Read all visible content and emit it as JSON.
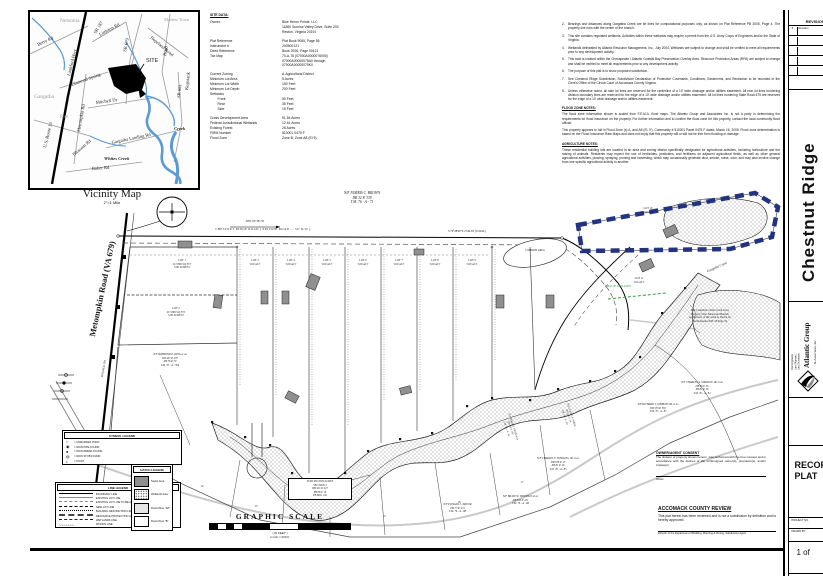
{
  "colors": {
    "navy_dash": "#23337f",
    "septic_fill": "#8f8f8f",
    "flood_gray": "#c9c9c9",
    "green_line": "#2e9e3a",
    "creek_blue": "#5b9bd5"
  },
  "vicinity": {
    "caption": "Vicinity Map",
    "scale": "2\"=1 Mile",
    "labels": {
      "nelsonia": "Nelsonia",
      "modest_town": "Modest\nTown",
      "gargatha": "Gargatha",
      "rue": "Rue",
      "berry": "Berry Rd",
      "lankford": "Lankford Hwy",
      "us13": "U.S. Route 13",
      "diamond": "Diamond\nSpring",
      "metompkin": "Metompkin Rd",
      "mitchell": "Mitchell Dr",
      "sr187": "SR 187",
      "sr679": "SR 679",
      "sr681": "SR 681",
      "littleton": "Littleton Rd",
      "hopeland": "Hopeland Road",
      "kegotank": "Kegotank",
      "road": "Road",
      "gargatha_landing": "Gargatha Landing Rd",
      "baker": "Baker Rd",
      "blossom": "Blossom Rd",
      "whites_creek": "Whites Creek",
      "creek": "Creek",
      "site": "SITE"
    }
  },
  "site_data": {
    "heading": "SITE DATA:",
    "rows": [
      {
        "label": "Owner:",
        "value": "Blue Heron Pointe, LLC\n11860 Sunrise Valley Drive, Suite 200\nReston, Virginia 20191",
        "cls": ""
      },
      {
        "label": "Plat Reference",
        "value": "Plat Book 9065, Page 56",
        "cls": "gap"
      },
      {
        "label": "Instrument #",
        "value": "200500121",
        "cls": ""
      },
      {
        "label": "Deed Reference",
        "value": "Book 2926, Page 00121",
        "cls": ""
      },
      {
        "label": "Tax Map",
        "value": "70-A-76 (07000A0000076000)\n07000A00000075A0 through\n07000A00000075K0",
        "cls": ""
      },
      {
        "label": "Current Zoning",
        "value": "A-Agricultural District",
        "cls": "gap"
      },
      {
        "label": "Minimum Lot Area",
        "value": "5 Acres",
        "cls": ""
      },
      {
        "label": "Minimum Lot Width",
        "value": "150 Feet",
        "cls": ""
      },
      {
        "label": "Minimum Lot Depth",
        "value": "200 Feet",
        "cls": ""
      },
      {
        "label": "Setbacks",
        "value": "",
        "cls": ""
      },
      {
        "label": "        Front",
        "value": "50 Feet",
        "cls": ""
      },
      {
        "label": "        Rear",
        "value": "35 Feet",
        "cls": ""
      },
      {
        "label": "        Side",
        "value": "15 Feet",
        "cls": ""
      },
      {
        "label": "Gross Development Area",
        "value": "91.54 Acres",
        "cls": "gap"
      },
      {
        "label": "Federal Jurisdictional Wetlands",
        "value": "12.61 Acres",
        "cls": ""
      },
      {
        "label": "Existing Forest",
        "value": "26 Acres",
        "cls": ""
      },
      {
        "label": "FIRM Number",
        "value": "510001 0475 F",
        "cls": ""
      },
      {
        "label": "Flood Zone",
        "value": "Zone B, Zone A8 (El 9)",
        "cls": ""
      }
    ]
  },
  "notes": {
    "items": [
      {
        "n": "2.",
        "text": "Bearings and distances along Gargatha Creek are tie lines for computational purposes only, as shown on Plat Reference PB 3005, Page 4. The property line runs with the center of the branch."
      },
      {
        "n": "3.",
        "text": "This site contains regulated wetlands. Activities within these wetlands may require a permit from the U.S. Army Corps of Engineers and/or the State of Virginia."
      },
      {
        "n": "4.",
        "text": "Wetlands delineated by Atlantic Resource Management, Inc., July 2004. Wetlands are subject to change and shall be verified to meet all requirements prior to any development activity."
      },
      {
        "n": "5.",
        "text": "This tract is located within the Chesapeake / Atlantic Coastal Bay Preservation Overlay Area. Resource Protection Areas (RPA) are subject to change and shall be verified to meet all requirements prior to any development activity."
      },
      {
        "n": "6.",
        "text": "The purpose of this plat is to show proposed subdivision."
      },
      {
        "n": "7.",
        "text": "See Chestnut Ridge Subdivision, Subdivision Declaration of Protective Covenants, Conditions, Easements, and Restriction to be recorded in the Clerk's Office of the Circuit Court of Accomack County Virginia."
      },
      {
        "n": "8.",
        "text": "Unless otherwise noted, all side lot lines are reserved for the centerline of a 10' wide drainage and/or utilities easement. All rear lot lines bordering division boundary lines are reserved for the edge of a 10' wide drainage and/or utilities easement. All lot lines bordering State Road 679 are reserved for the edge of a 10' wide drainage and/or utilities easement."
      }
    ],
    "flood_heading": "FLOOD ZONE NOTES:",
    "flood_paras": [
      "The flood zone information shown is scaled from F.E.M.A. flood maps. The Atlantic Group and Associates Inc. is not a party in determining the requirements for flood insurance on the property. For further information and to confirm the flood zone for this property, contact the local community flood official.",
      "This property appears to fall in Flood Zone (s) A, and A8 (El. 9'). Community # 510001 Panel 0475 F dated, March 16, 2009. Flood zone determination is based on the Flood Insurance Rate Maps and does not imply that this property will or will not be free from flooding or damage."
    ],
    "agri_heading": "AGRICULTURE NOTES:",
    "agri_paras": [
      "These residential building lots are located in an area and zoning district specifically designated for agricultural activities, including horticulture and the raising of animals. Residents may expect the use of herbicides, pesticides, and fertilizers on adjacent agricultural fields, as well as other general agricultural activities, plowing, spraying, pruning and harvesting, which may occasionally generate dust, smoke, noise, odor, and may also involve change from one specific agricultural activity to another."
    ]
  },
  "plan": {
    "roads": {
      "metompkin": "Metompkin Road (VA 679)",
      "mitchell": "MITCHELL DR",
      "chestnut": "CHESTNUT RIDGE ROAD    ( PRIVATE ROAD — 50' R/W )",
      "bearing": "S 79°28'00\"E   2746.38' (TOTAL)",
      "tie": "DIST OF 387.50'"
    },
    "lots": {
      "lot1": "LOT 1\n217,800 SQ FT±\n5.00 ACRES±",
      "lot2": "LOT 2\n217,800 SQ FT±\n5.00 ACRES±",
      "lot3": "LOT 3\n5.00 AC±",
      "lot4": "LOT 4\n5.00 AC±",
      "lot5": "LOT 5\n5.00 AC±",
      "lot6": "LOT 6\n5.00 AC±",
      "lot7": "LOT 7\n5.00 AC±",
      "lot8": "LOT 8\n5.00 AC±",
      "lot9": "LOT 9\n5.00 AC±",
      "lot10": "LOT 10\n4.50 AC±",
      "lot11": "LOT 11\n5.04 AC±",
      "p12": "12",
      "p13": "13",
      "p14": "14",
      "p15": "15",
      "p16": "16",
      "p17": "17"
    },
    "neighbors": {
      "brown": "N/F NORRIS C. BROWN\nDB 32 P. 339\nT.M. 76 - A - 71",
      "king": "N/F RAYMOND E. KING et ux\nDB 467 P. 297\nPB 76 P. 79\nT.M. 76 - A - 76A",
      "taylor": "N/F DONALD J. TAYLOR\nDB 77 P. 474\nT.M. 76 - A - 88",
      "wessells": "N/F BILLIE W. WESSELLS et ux\nDB 553 P. 231\nT.M. 76 - A - 86",
      "sterling": "N/F CHARLES F. STERLING JR. et ux\nDB 678 P. 47\nPB 81 P. 16\nT.M. 76 - A - 85",
      "gibbons": "N/F RICHARD T. GIBBONS JR. et ux\nDB 553 P. 565\nT.M. 76 - A - 87",
      "strange": "N/F CHARLES A. STRANGE JR. et ux\nDB 96 P. 56\nPB 81 P. 56\nT.M. 76 - A - 84",
      "annis": "N/F JAMES R. ANNIS et ux\nDB 409 P. 180\nT.M. 76 - A - 82",
      "parks": "N/F GLADYS S. PARKS\nDB 380 P. 44\nT.M. 76 - A - 83"
    },
    "annotations": {
      "creek_note": "The Centerline of the Creek is the\nProperty Line. Metes and Bounds\nare hollows of the creek as shown on\nPlat Reference P.B. 96 Page 56.",
      "turlington": "TURLINGTON ACRES\nSECTION 2\nDB 451 P. 227\nPB 88 P. 16\nPB 88 P. 110",
      "gargatha_creek": "Gargatha Creek",
      "common_area": "COMMON AREA",
      "green_mark": "EDGE OF WETLANDS"
    }
  },
  "symbol_legend": {
    "title": "SYMBOL LEGEND",
    "items": [
      {
        "glyph": "○",
        "label": "=  UNMARKED POINT"
      },
      {
        "glyph": "◉",
        "label": "=  IRON PIPE FOUND"
      },
      {
        "glyph": "●",
        "label": "=  IRON REBAR FOUND"
      },
      {
        "glyph": "◍",
        "label": "=  IRON STOB FOUND"
      },
      {
        "glyph": "•",
        "label": "=  POINT"
      }
    ]
  },
  "line_legend": {
    "title": "LINE LEGEND",
    "items": [
      {
        "style": "ls-bound",
        "glyph": "",
        "label": "BOUNDARY LINE"
      },
      {
        "style": "ls-exist",
        "glyph": "",
        "label": "EXISTING LOT LINE"
      },
      {
        "style": "ls-aband",
        "glyph": "",
        "label": "EXISTING LOT LINE TO BE ABANDONED"
      },
      {
        "style": "ls-new",
        "glyph": "",
        "label": "NEW LOT LINE"
      },
      {
        "style": "ls-brl",
        "glyph": "",
        "label": "BUILDING RESTRICTION LINE"
      },
      {
        "style": "ls-rpa",
        "glyph": "",
        "label": "RESOURCE PROTECTION AREA BUFFER"
      },
      {
        "style": "ls-wet",
        "glyph": "",
        "label": "WETLANDS LINE"
      },
      {
        "style": "ls-woods",
        "glyph": "∿∿∿∿∿∿∿",
        "label": "WOODS LINE"
      }
    ]
  },
  "hatch_legend": {
    "title": "HATCH LEGEND",
    "items": [
      {
        "style": "hs-septic",
        "label": "Septic Area"
      },
      {
        "style": "hs-wet",
        "label": "Wetlands Area"
      },
      {
        "style": "hs-fa8",
        "label": "Flood Zone \"A8\""
      },
      {
        "style": "hs-fb",
        "label": "Flood Zone \"B\""
      }
    ]
  },
  "scale": {
    "title": "GRAPHIC SCALE",
    "caption": "( IN FEET )\n1 inch = 200 ft."
  },
  "consent": {
    "title": "OWNER/AGENT CONSENT",
    "body": "The division of property shown hereon, was performed with the free consent and in accordance with the desires of the undersigned owner(s), proprietor(s), and/or trustee(s).",
    "sig": "Owner"
  },
  "review": {
    "title": "ACCOMACK COUNTY REVIEW",
    "body": "This plat herein has been reviewed and is not a subdivision by definition and is hereby approved.",
    "sig": "Director of the Department of Building, Planning & Zoning, Subdivision Agent"
  },
  "title_block": {
    "revisions": "REVISIONS",
    "rev_no": "#",
    "rev_desc": "Revision",
    "project_title": "Chestnut Ridge",
    "firm": "Atlantic Group",
    "firm2": "& Associates, Inc.",
    "services": "Civil Engineers\nLand Planners\nLand Surveyors",
    "address": "10044 Old Ocean City Boulevard",
    "sheet_type": "RECORD\nPLAT",
    "field1": "PROJECT NO.",
    "field2": "DRAWN BY:",
    "sheet_no": "1 of"
  }
}
